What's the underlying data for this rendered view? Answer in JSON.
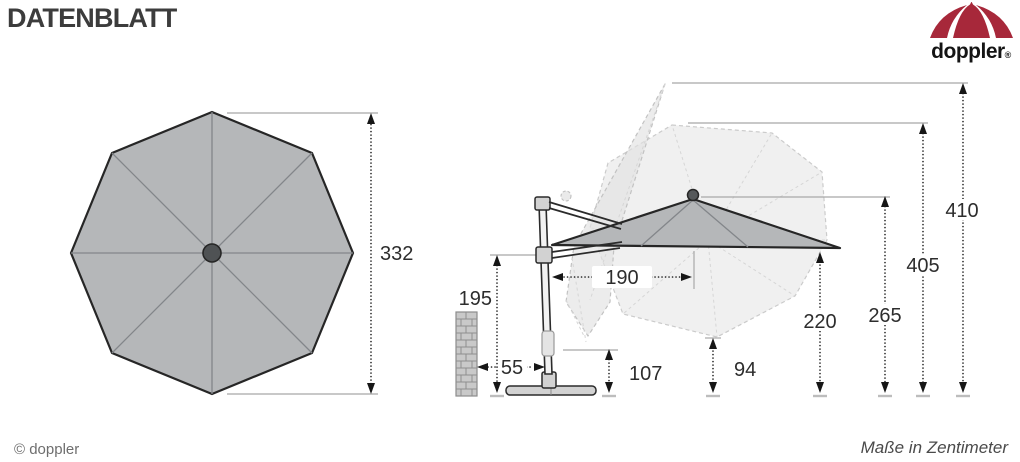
{
  "header": {
    "title": "DATENBLATT"
  },
  "logo": {
    "brand": "doppler",
    "registered": "®"
  },
  "footer": {
    "copyright": "© doppler",
    "units": "Maße in Zentimeter"
  },
  "dimensions": {
    "canopy_diameter": "332",
    "joint_height": "195",
    "wall_clearance": "55",
    "crank_height": "107",
    "canopy_offset": "190",
    "tilt_clearance": "94",
    "edge_clearance": "220",
    "hub_height": "265",
    "tilt_height": "405",
    "total_height": "410"
  },
  "colors": {
    "accent_red": "#A7283A",
    "canopy_gray": "#B5B7B9",
    "ghost_gray": "#F0F0F0"
  }
}
